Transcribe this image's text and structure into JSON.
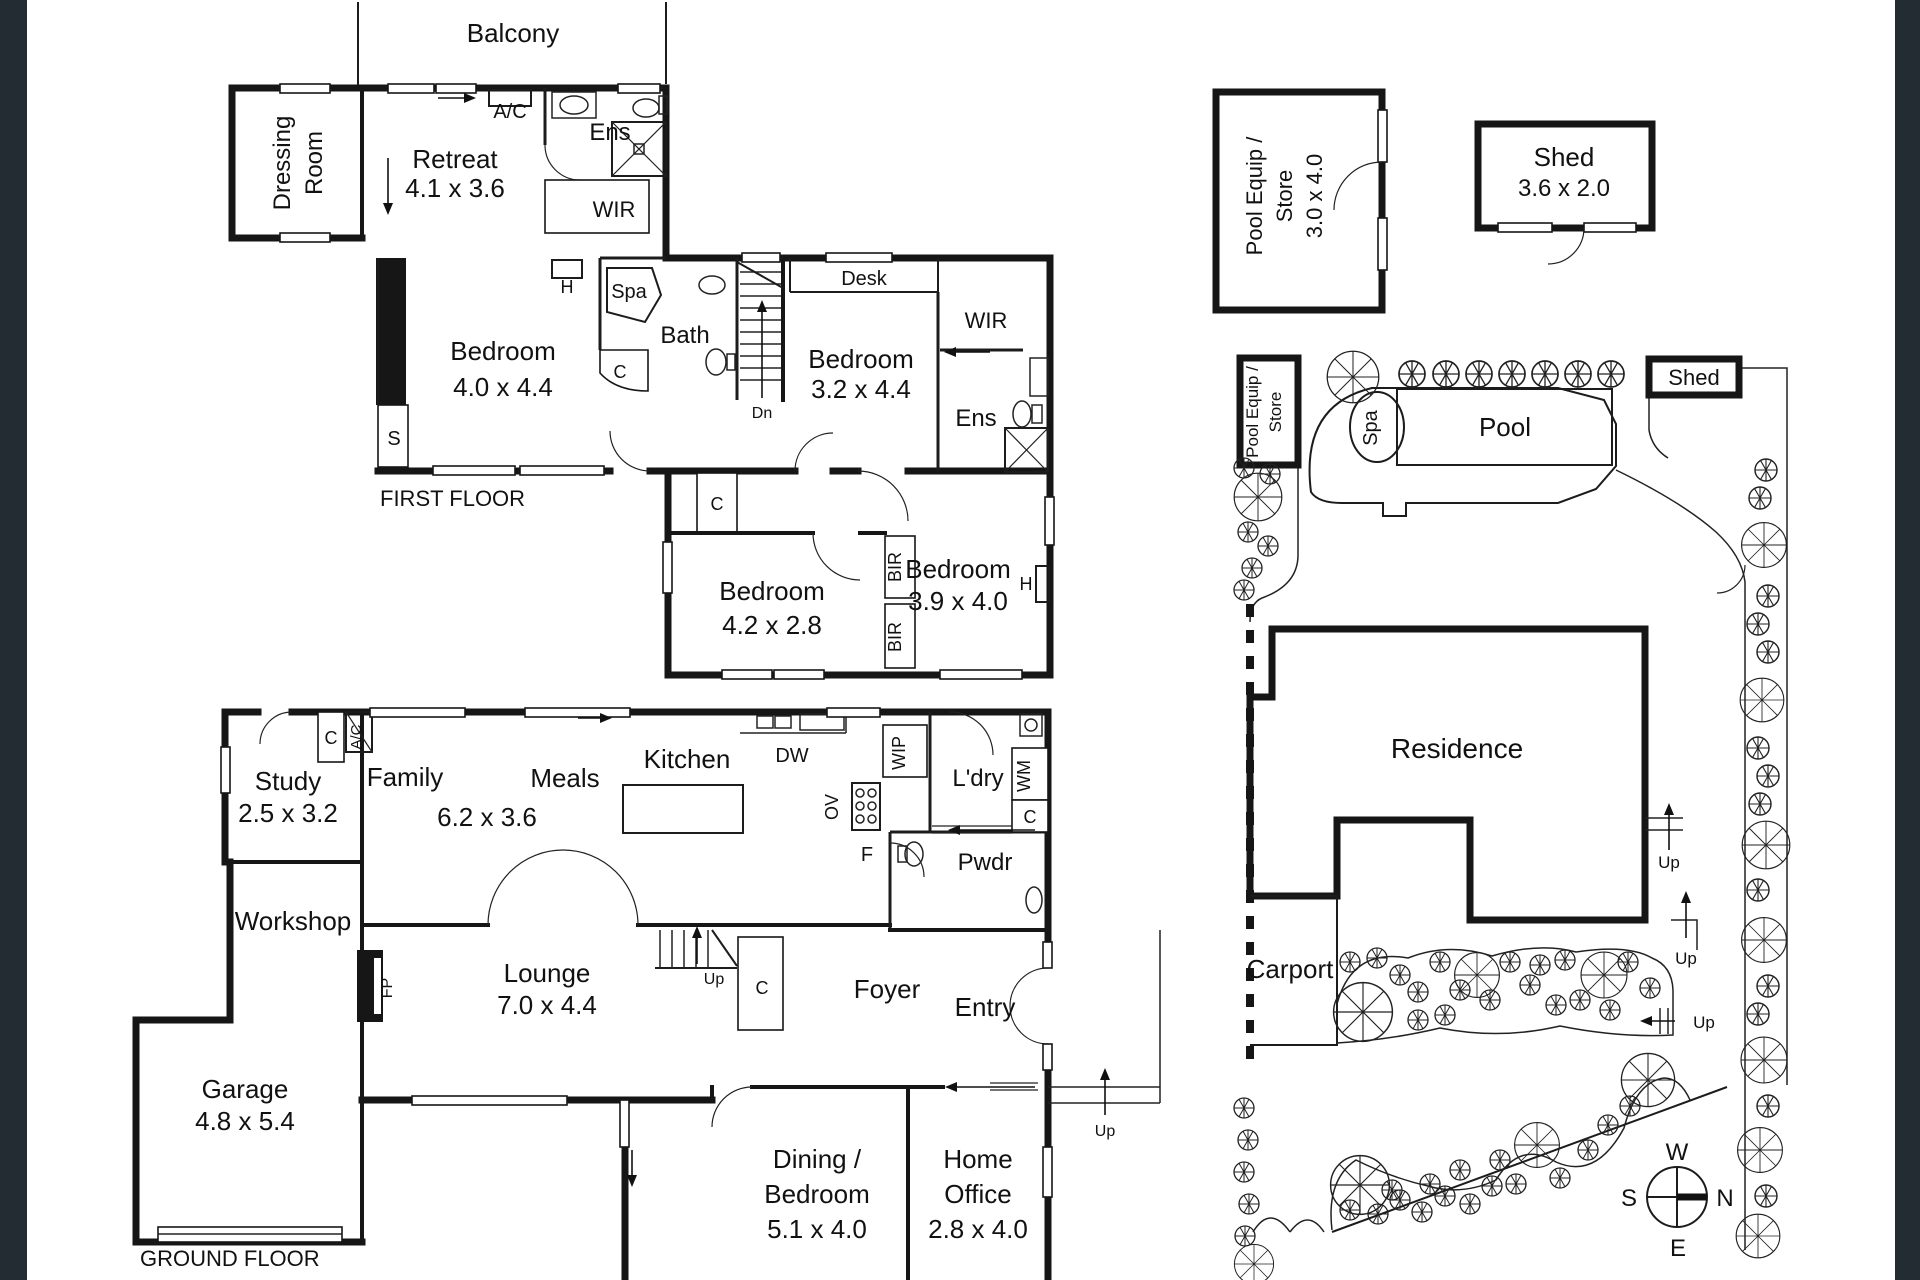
{
  "canvas": {
    "width": 1920,
    "height": 1280,
    "background": "#ffffff",
    "frame_color": "#232b33"
  },
  "labels": {
    "balcony": "Balcony",
    "dressing_1": "Dressing",
    "dressing_2": "Room",
    "retreat": "Retreat",
    "retreat_dims": "4.1 x 3.6",
    "ac": "A/C",
    "ens": "Ens",
    "wir": "WIR",
    "h": "H",
    "spa": "Spa",
    "bath": "Bath",
    "c": "C",
    "s": "S",
    "dn": "Dn",
    "up": "Up",
    "desk": "Desk",
    "bir": "BIR",
    "bedroom": "Bedroom",
    "bed1_dims": "4.0 x 4.4",
    "bed2_dims": "3.2 x 4.4",
    "bed3_dims": "4.2 x 2.8",
    "bed4_dims": "3.9 x 4.0",
    "first_floor": "FIRST FLOOR",
    "ground_floor": "GROUND FLOOR",
    "pool_equip_1": "Pool Equip /",
    "pool_equip_2": "Store",
    "pool_equip_dims": "3.0 x 4.0",
    "shed": "Shed",
    "shed_dims": "3.6 x 2.0",
    "study": "Study",
    "study_dims": "2.5 x 3.2",
    "family": "Family",
    "meals": "Meals",
    "family_dims": "6.2 x 3.6",
    "kitchen": "Kitchen",
    "dw": "DW",
    "wip": "WIP",
    "ov": "OV",
    "f": "F",
    "ldry": "L'dry",
    "wm": "WM",
    "pwdr": "Pwdr",
    "workshop": "Workshop",
    "fp": "FP",
    "lounge": "Lounge",
    "lounge_dims": "7.0 x 4.4",
    "foyer": "Foyer",
    "entry": "Entry",
    "garage": "Garage",
    "garage_dims": "4.8 x 5.4",
    "dining_1": "Dining /",
    "dining_2": "Bedroom",
    "dining_dims": "5.1 x 4.0",
    "office_1": "Home",
    "office_2": "Office",
    "office_dims": "2.8 x 4.0",
    "pool": "Pool",
    "residence": "Residence",
    "carport": "Carport",
    "compass_n": "N",
    "compass_s": "S",
    "compass_e": "E",
    "compass_w": "W"
  }
}
